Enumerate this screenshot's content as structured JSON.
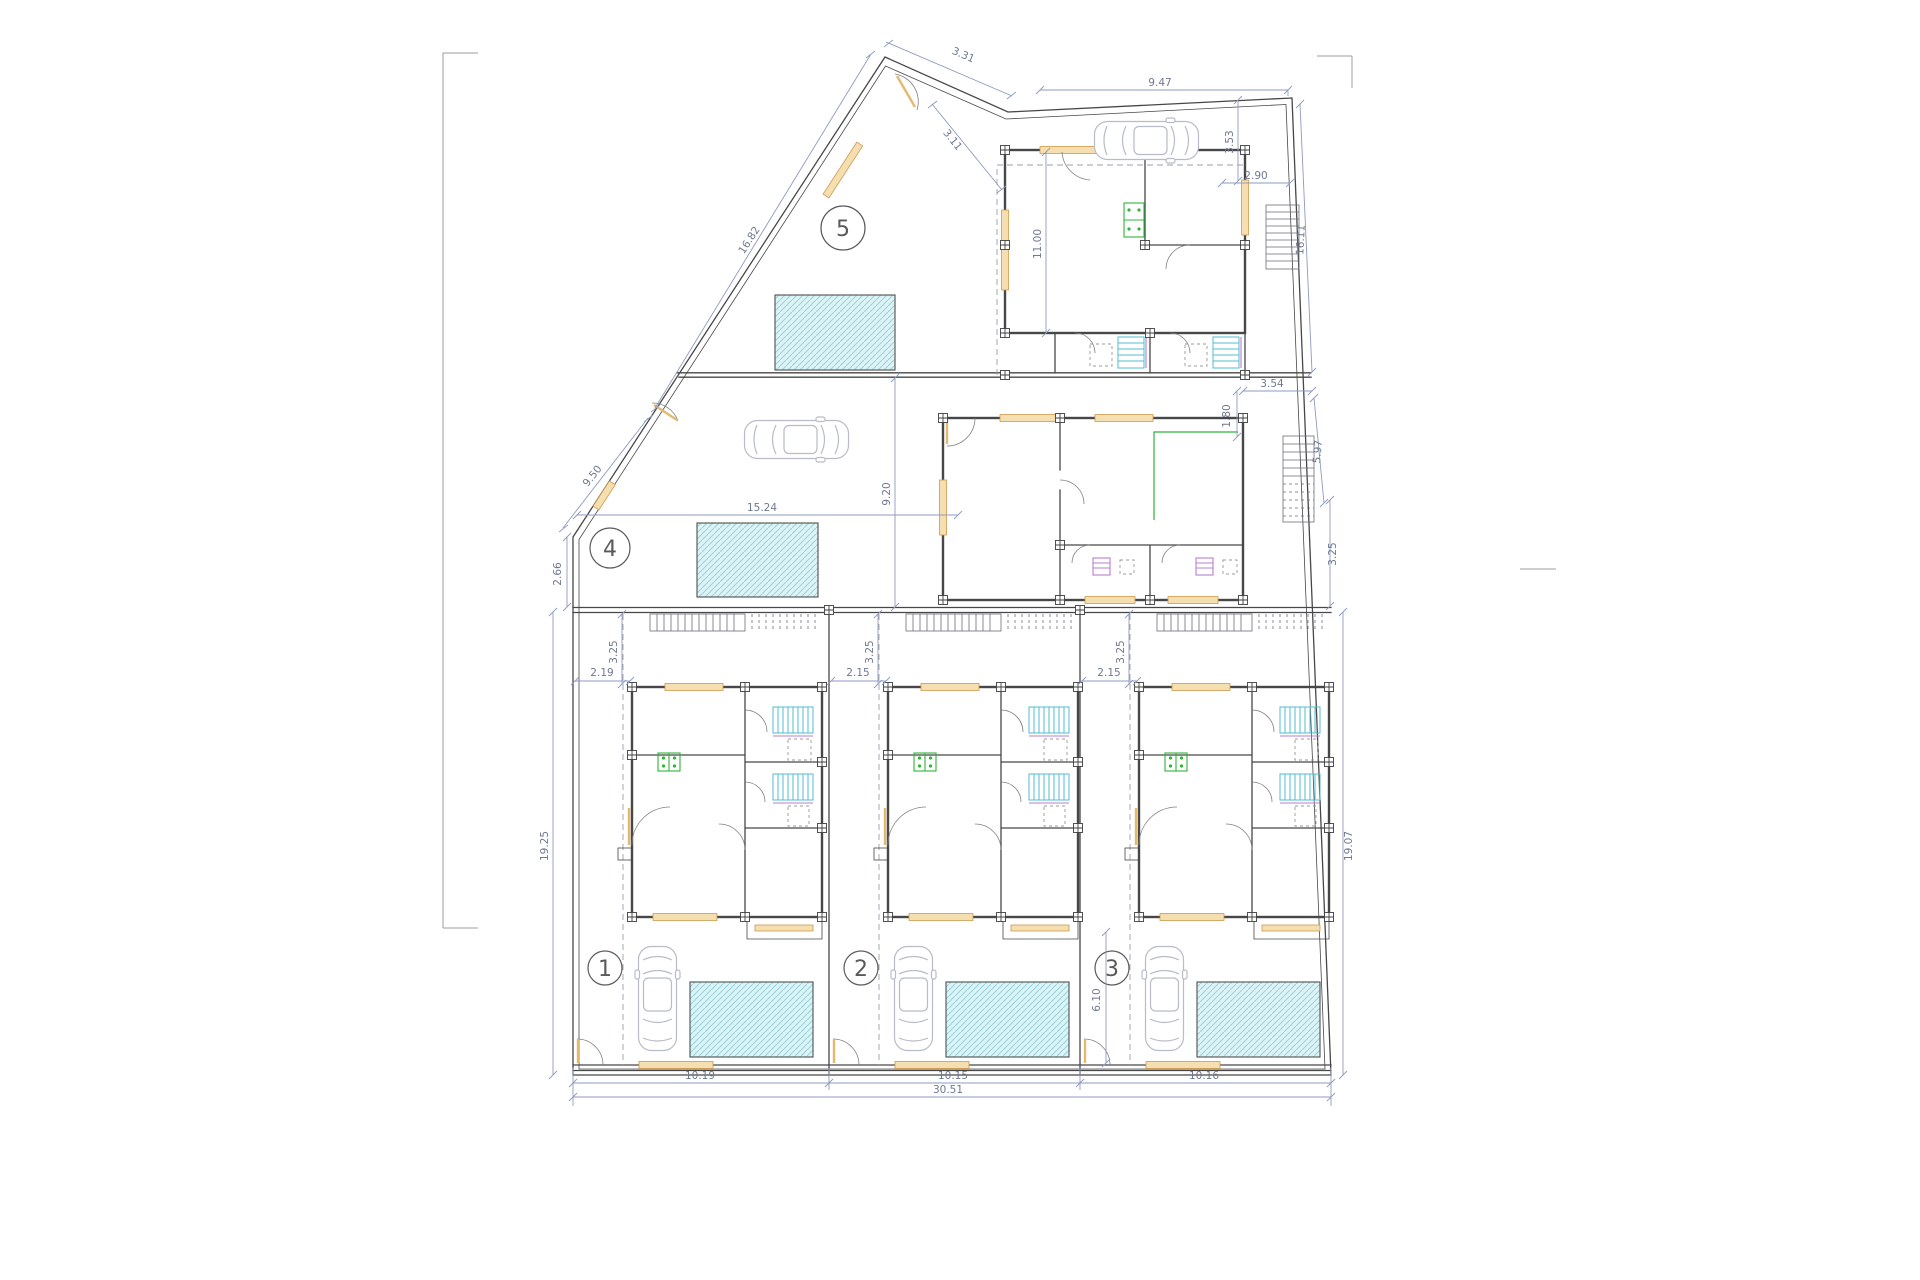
{
  "drawing": {
    "type": "site-floor-plan",
    "units_count": 5
  },
  "colors": {
    "wall": "#474747",
    "dim": "#8e9bc0",
    "dim_text": "#6f7890",
    "window_fill": "#f5deb0",
    "window_stroke": "#cf9a4e",
    "pool_fill": "#def3f6",
    "pool_hatch": "#96d6de",
    "kitchen": "#2eb53a",
    "shower": "#52bdd2",
    "fixture": "#b87fd0",
    "tray": "#9a9a9a",
    "car": "#b7bcc8",
    "circle": "#5a5a5a",
    "dash": "#9aa0a8",
    "frame": "#9e9e9e",
    "leaf": "#e4b96e",
    "stair": "#6a6f7a"
  },
  "units": [
    {
      "number": "1"
    },
    {
      "number": "2"
    },
    {
      "number": "3"
    },
    {
      "number": "4"
    },
    {
      "number": "5"
    }
  ],
  "dims": {
    "top_width": "9.47",
    "apex_segment": "3.31",
    "apex_inset": "3.11",
    "right_upper": "3.53",
    "right_upper_offset": "2.90",
    "diagonal_upper": "16.82",
    "diagonal_lower": "9.50",
    "unit5_house_depth": "11.00",
    "right_boundary_upper": "16.11",
    "right_stair_run": "5.97",
    "unit5_right_gap": "3.54",
    "unit5_right_jog": "1.80",
    "right_mid": "3.25",
    "unit4_left_edge": "2.66",
    "unit4_width": "15.24",
    "unit4_court_depth": "9.20",
    "left_depth": "19.25",
    "right_depth": "19.07",
    "unit1_front": "3.25",
    "unit2_front": "3.25",
    "unit3_front": "3.25",
    "unit1_side": "2.19",
    "unit2_side": "2.15",
    "unit3_side": "2.15",
    "unit3_yard": "6.10",
    "unit1_width": "10.19",
    "unit2_width": "10.15",
    "unit3_width": "10.16",
    "total_width": "30.51"
  }
}
